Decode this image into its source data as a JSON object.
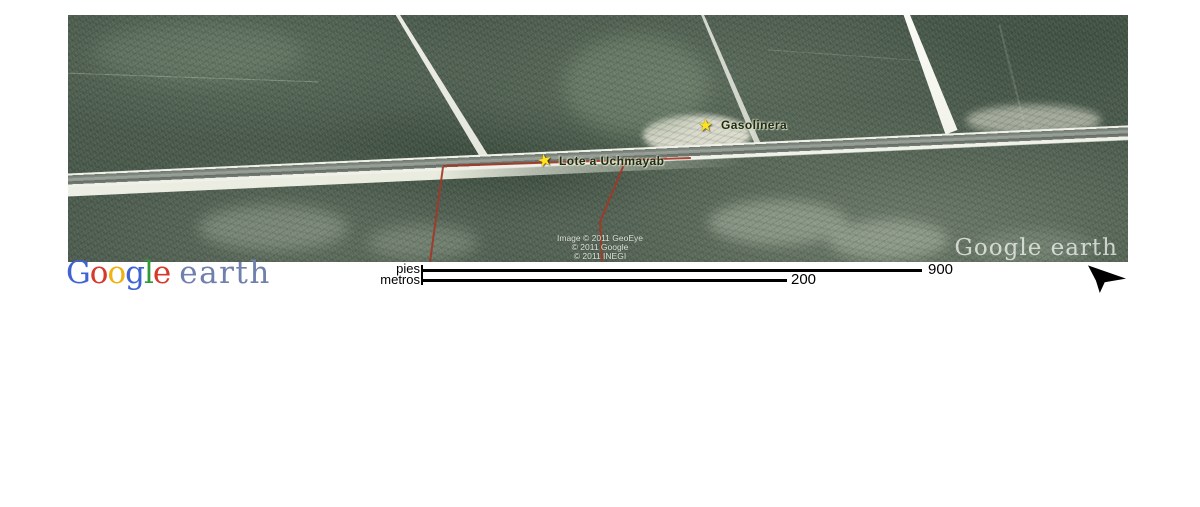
{
  "app_title": "Google Earth",
  "map": {
    "placemarks": [
      {
        "label": "Gasolinera"
      },
      {
        "label": "Lote a Uchmayab"
      }
    ],
    "attribution": [
      "Image © 2011 GeoEye",
      "© 2011 Google",
      "© 2011 INEGI"
    ],
    "watermark": "Google earth"
  },
  "icons": {
    "placemark_star": "★"
  },
  "footer": {
    "logo": {
      "letters": [
        {
          "ch": "G",
          "style": "color:#3f63d2"
        },
        {
          "ch": "o",
          "style": "color:#d6392c"
        },
        {
          "ch": "o",
          "style": "color:#eeb211"
        },
        {
          "ch": "g",
          "style": "color:#3f63d2"
        },
        {
          "ch": "l",
          "style": "color:#2f9b38"
        },
        {
          "ch": "e",
          "style": "color:#d6392c"
        }
      ],
      "earth_word": "earth",
      "earth_style": "color:#6e80ab"
    },
    "scale": {
      "pies_label": "pies",
      "pies_value": "900",
      "metros_label": "metros",
      "metros_value": "200"
    }
  },
  "colors": {
    "boundary_red": "#a33727",
    "placemark_yellow": "#ffe21e",
    "asphalt_gray": "#848d84",
    "forest_green": "#49594b"
  }
}
